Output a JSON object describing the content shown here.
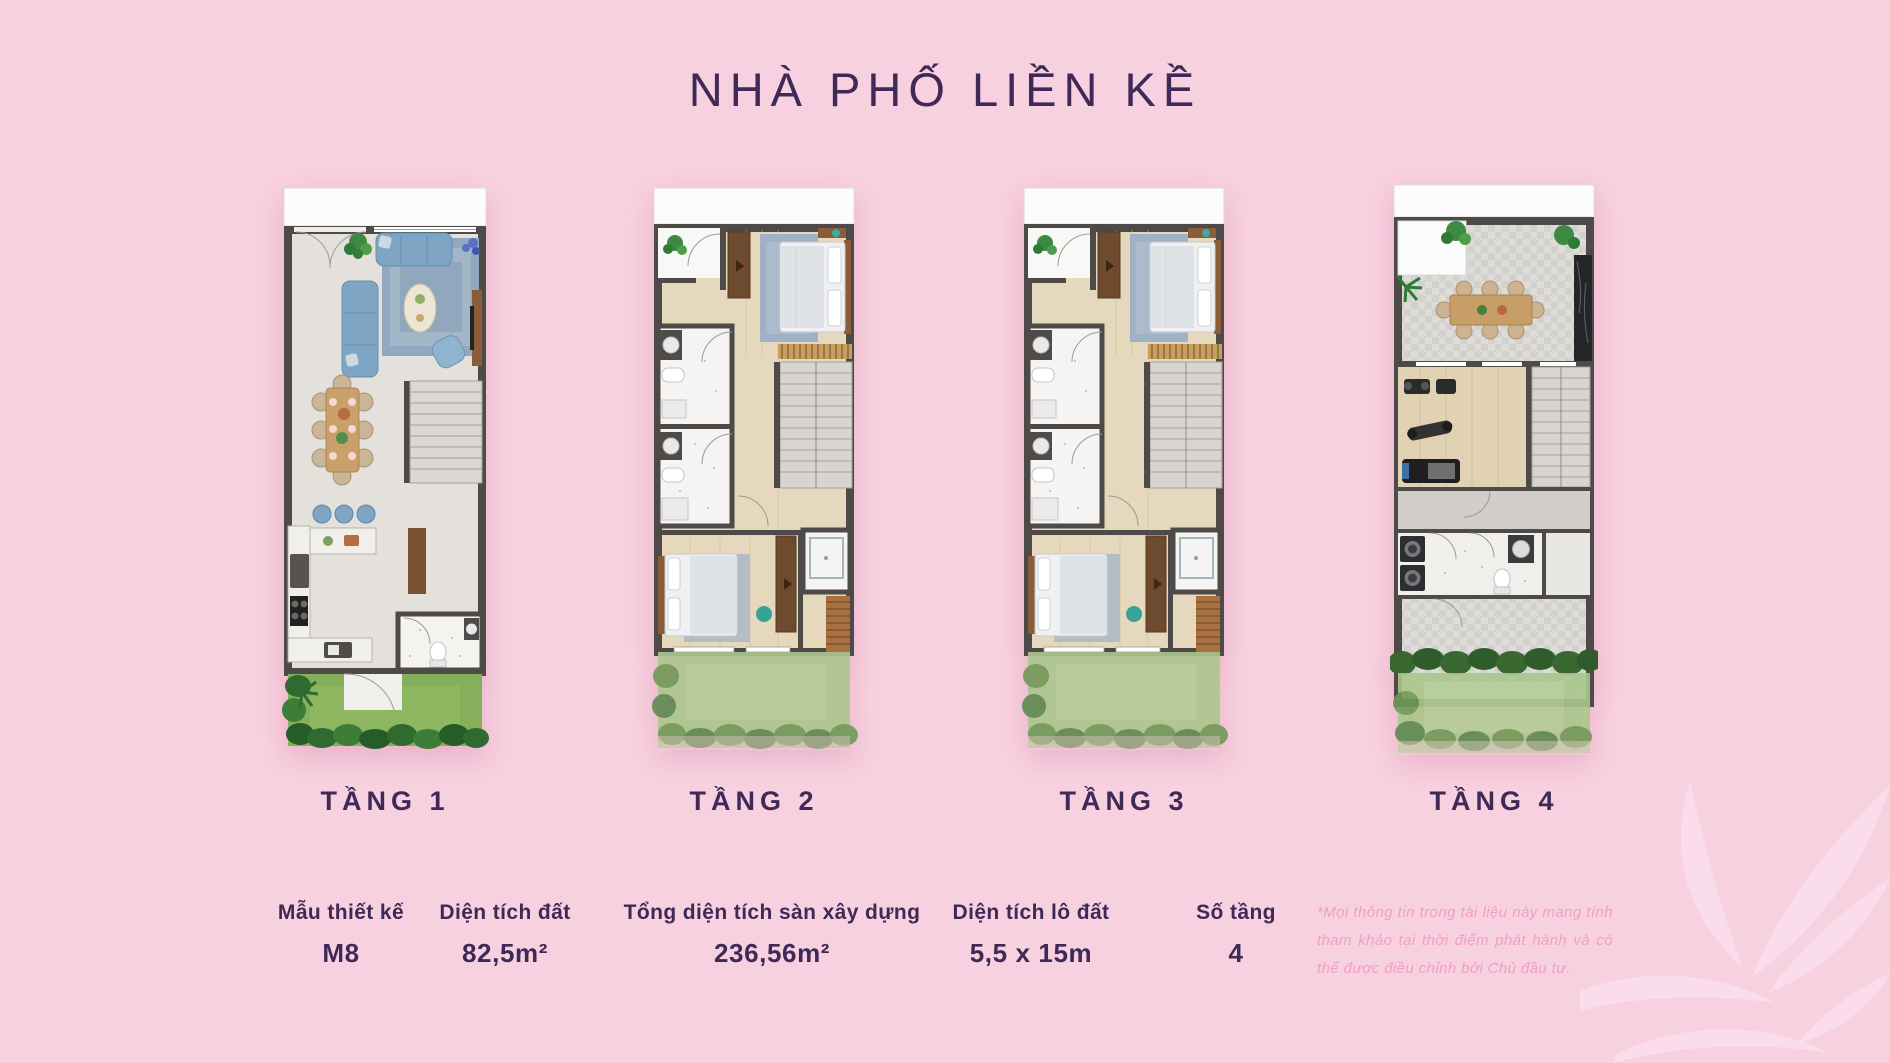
{
  "title": "NHÀ PHỐ LIỀN KỀ",
  "floors": [
    {
      "label": "TẦNG 1"
    },
    {
      "label": "TẦNG 2"
    },
    {
      "label": "TẦNG 3"
    },
    {
      "label": "TẦNG 4"
    }
  ],
  "specs": [
    {
      "label": "Mẫu thiết kế",
      "value": "M8"
    },
    {
      "label": "Diện tích đất",
      "value": "82,5m²"
    },
    {
      "label": "Tổng diện tích sàn xây dựng",
      "value": "236,56m²"
    },
    {
      "label": "Diện tích lô đất",
      "value": "5,5 x 15m"
    },
    {
      "label": "Số tầng",
      "value": "4"
    }
  ],
  "disclaimer": {
    "lines": [
      "*Mọi thông tin trong tài liệu này mang tính",
      "tham khảo tại thời điểm phát hành và có",
      "thể được điều chỉnh bởi Chủ đầu tư."
    ]
  },
  "colors": {
    "background": "#f8d1e0",
    "accent_purple": "#3f2956",
    "disclaimer_pink": "#f09fc0",
    "leaf_pink": "#fbdcea"
  }
}
